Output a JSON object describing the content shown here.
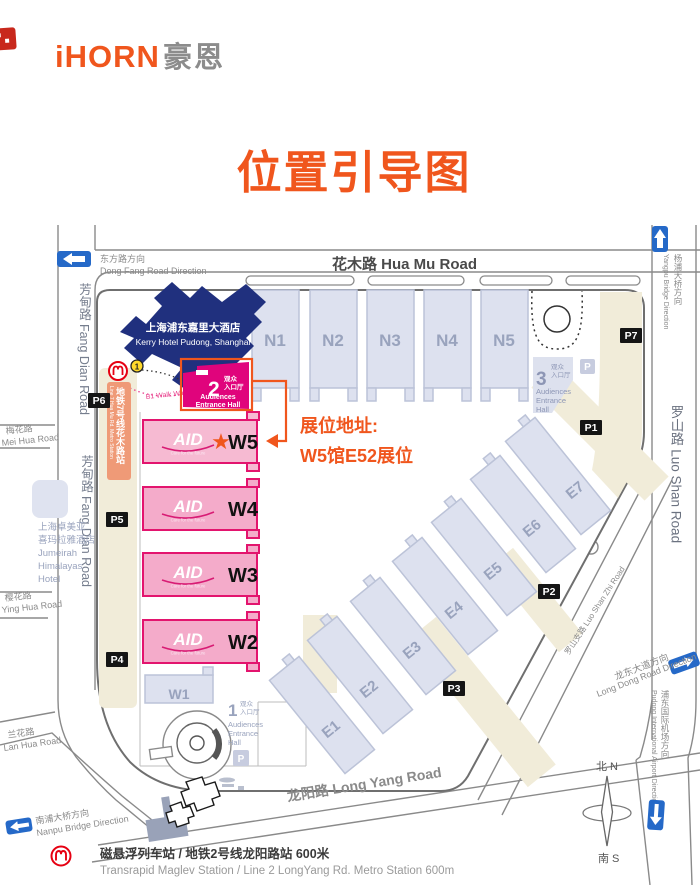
{
  "brand": {
    "logo_en": "iHORN",
    "logo_zh": "豪恩"
  },
  "title": "位置引导图",
  "annotation": {
    "heading": "展位地址:",
    "booth": "W5馆E52展位"
  },
  "roads": {
    "hua_mu": "花木路 Hua Mu Road",
    "fang_dian": "芳甸路 Fang Dian Road",
    "mei_hua_zh": "梅花路",
    "mei_hua_en": "Mei Hua Road",
    "ying_hua_zh": "樱花路",
    "ying_hua_en": "Ying Hua Road",
    "lan_hua_zh": "兰花路",
    "lan_hua_en": "Lan Hua Road",
    "luo_shan": "罗山路 Luo Shan Road",
    "luo_shan_zhi": "罗山支路 Luo Shan Zhi Road",
    "long_yang": "龙阳路 Long Yang Road"
  },
  "directions": {
    "dong_fang_zh": "东方路方向",
    "dong_fang_en": "Dong Fang Road Direction",
    "yangpu_zh": "杨浦大桥方向",
    "yangpu_en": "Yangpu Bridge Direction",
    "nanpu_zh": "南浦大桥方向",
    "nanpu_en": "Nanpu Bridge Direction",
    "long_dong_zh": "龙东大道方向",
    "long_dong_en": "Long Dong Road Direction",
    "airport_zh": "浦东国际机场方向",
    "airport_en": "Pudong International Airport Direction"
  },
  "landmarks": {
    "kerry_zh": "上海浦东嘉里大酒店",
    "kerry_en": "Kerry Hotel Pudong, Shanghai",
    "jumeirah_lines": [
      "上海卓美亚",
      "喜玛拉雅酒店",
      "Jumeirah",
      "Himalayas",
      "Hotel"
    ],
    "walkway_2f": "2F Walk Way",
    "walkway_b1": "B1 Walk Way"
  },
  "metro": {
    "line7_zh": "地铁7号线花木路站",
    "line7_en": "Line 7 Hua Mu Rd. Metro Station",
    "exit_badge": "1"
  },
  "entrances": {
    "e1_num": "1",
    "e2_num": "2",
    "e3_num": "3",
    "zh_line1": "观众",
    "zh_line2": "入口厅",
    "en_inline2": "Entrance Hall",
    "en_l1": "Audiences",
    "en_l2": "Entrance",
    "en_l3": "Hall"
  },
  "halls": {
    "n": [
      "N1",
      "N2",
      "N3",
      "N4",
      "N5"
    ],
    "w": [
      "W5",
      "W4",
      "W3",
      "W2"
    ],
    "w1": "W1",
    "e": [
      "E1",
      "E2",
      "E3",
      "E4",
      "E5",
      "E6",
      "E7"
    ]
  },
  "aid": {
    "name": "AID",
    "tagline": "Care for the future"
  },
  "parking": {
    "p1": "P1",
    "p2": "P2",
    "p3": "P3",
    "p4": "P4",
    "p5": "P5",
    "p6": "P6",
    "p7": "P7",
    "p": "P"
  },
  "compass": {
    "north": "北 N",
    "south": "南 S"
  },
  "footer": {
    "zh": "磁悬浮列车站 / 地铁2号线龙阳路站 600米",
    "en": "Transrapid Maglev Station / Line 2 LongYang Rd. Metro Station   600m"
  },
  "star": "★",
  "colors": {
    "orange": "#f0561d",
    "magenta": "#e0047c",
    "hall_pink": "#f4abca",
    "hall_pink_stroke": "#e3146e",
    "navy": "#20307e",
    "blue": "#2569c8",
    "metro_red": "#e60012",
    "beige": "#f1ecd9",
    "hall_gray": "#dde1ef"
  }
}
